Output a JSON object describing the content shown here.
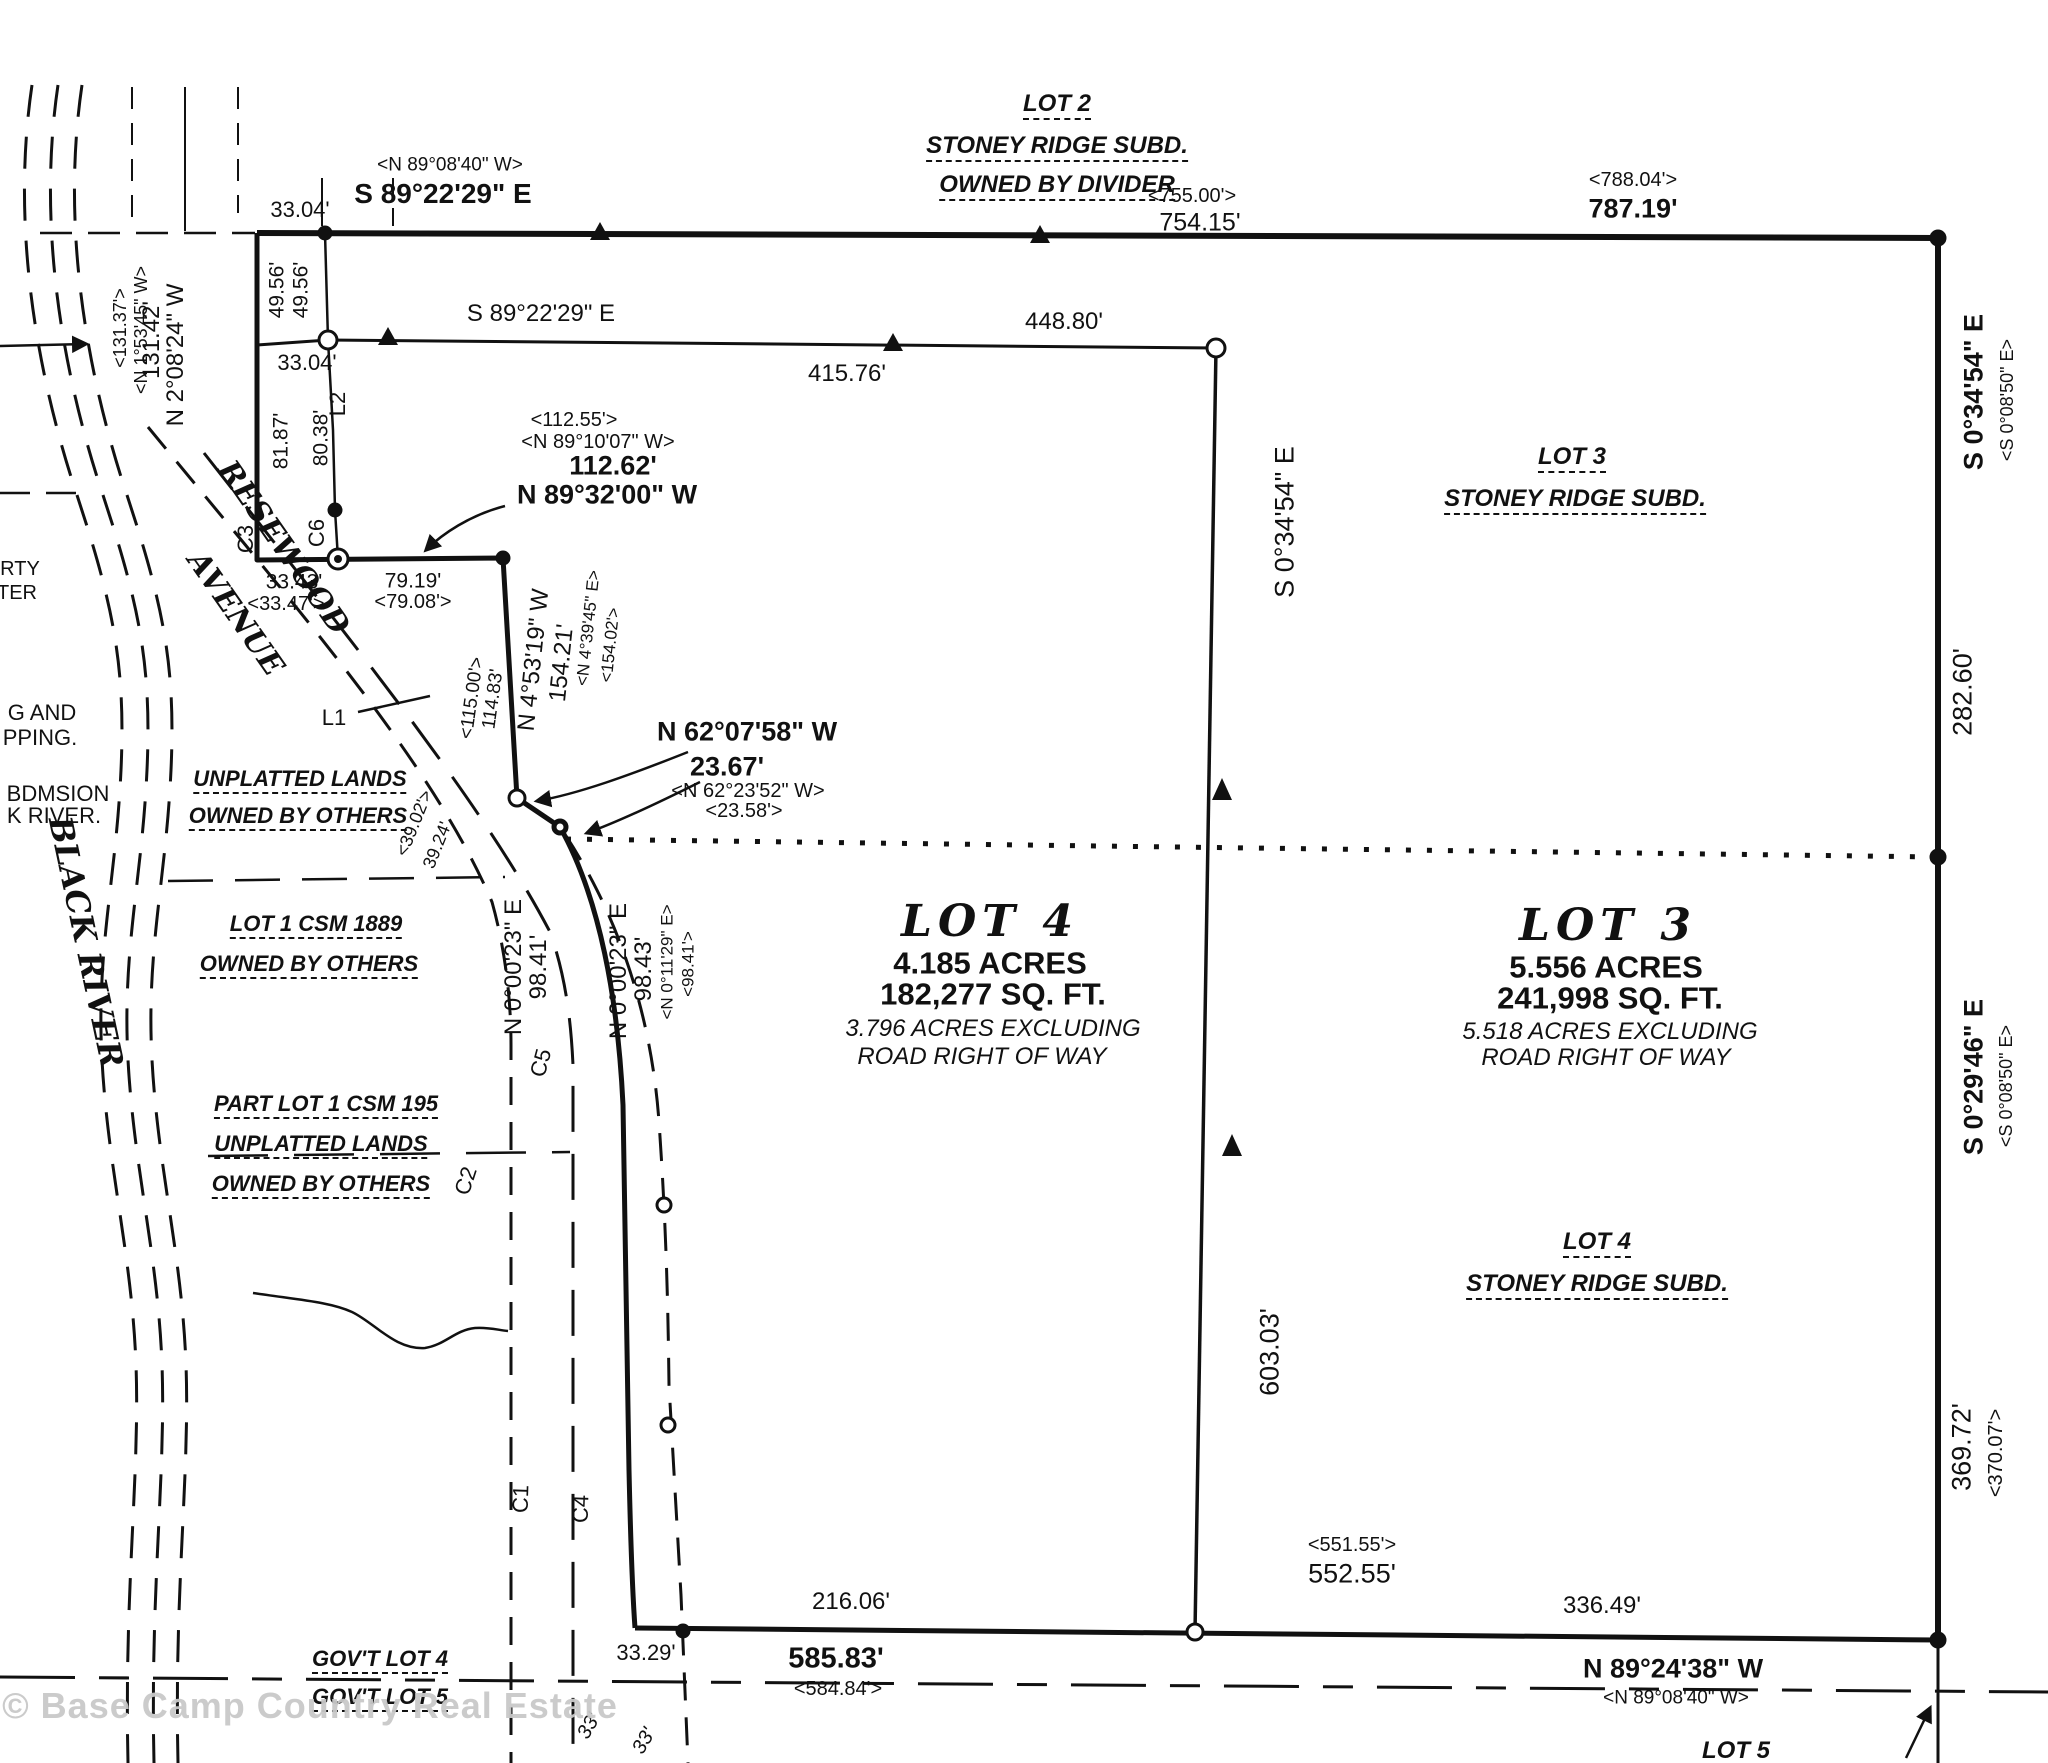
{
  "document_type": "survey-plat-drawing",
  "colors": {
    "ink": "#111111",
    "paper": "#ffffff",
    "watermark": "#c9c9c9"
  },
  "labels": [
    {
      "id": "dim-3304-top",
      "text": "33.04'",
      "x": 300,
      "y": 210,
      "size": 22
    },
    {
      "id": "brg-s892229e-top",
      "text": "S 89°22'29\" E",
      "x": 443,
      "y": 194,
      "size": 28,
      "cls": "bold"
    },
    {
      "id": "brg-n890840w-top",
      "text": "<N 89°08'40\" W>",
      "x": 450,
      "y": 165,
      "size": 19
    },
    {
      "id": "lot2-title",
      "text": "LOT 2",
      "x": 1057,
      "y": 106,
      "size": 24,
      "cls": "itu"
    },
    {
      "id": "lot2-subd",
      "text": "STONEY RIDGE SUBD.",
      "x": 1057,
      "y": 148,
      "size": 24,
      "cls": "itu"
    },
    {
      "id": "lot2-owner",
      "text": "OWNED BY DIVIDER",
      "x": 1057,
      "y": 187,
      "size": 24,
      "cls": "itu"
    },
    {
      "id": "dim-75500",
      "text": "<755.00'>",
      "x": 1192,
      "y": 196,
      "size": 20
    },
    {
      "id": "dim-75415",
      "text": "754.15'",
      "x": 1200,
      "y": 223,
      "size": 25
    },
    {
      "id": "dim-78804",
      "text": "<788.04'>",
      "x": 1633,
      "y": 180,
      "size": 20
    },
    {
      "id": "dim-78719",
      "text": "787.19'",
      "x": 1633,
      "y": 209,
      "size": 27,
      "cls": "bold"
    },
    {
      "id": "dim-4956-a",
      "text": "49.56'",
      "x": 277,
      "y": 290,
      "size": 21,
      "rot": -90
    },
    {
      "id": "dim-4956-b",
      "text": "49.56'",
      "x": 301,
      "y": 290,
      "size": 21,
      "rot": -90
    },
    {
      "id": "dim-13142",
      "text": "131.42'",
      "x": 152,
      "y": 340,
      "size": 24,
      "rot": -90
    },
    {
      "id": "brg-n20824w",
      "text": "N 2°08'24\" W",
      "x": 176,
      "y": 355,
      "size": 24,
      "rot": -90
    },
    {
      "id": "dim-13137",
      "text": "<131.37'>",
      "x": 120,
      "y": 328,
      "size": 18,
      "rot": -90
    },
    {
      "id": "brg-n15345w",
      "text": "<N 1°53'45\" W>",
      "x": 141,
      "y": 330,
      "size": 18,
      "rot": -90
    },
    {
      "id": "brg-s892229e-2",
      "text": "S 89°22'29\" E",
      "x": 541,
      "y": 314,
      "size": 24
    },
    {
      "id": "dim-44880",
      "text": "448.80'",
      "x": 1064,
      "y": 322,
      "size": 24
    },
    {
      "id": "dim-41576",
      "text": "415.76'",
      "x": 847,
      "y": 374,
      "size": 24
    },
    {
      "id": "dim-3304-2",
      "text": "33.04'",
      "x": 307,
      "y": 363,
      "size": 22
    },
    {
      "id": "lbl-l2",
      "text": "L2",
      "x": 338,
      "y": 404,
      "size": 22,
      "rot": -90
    },
    {
      "id": "dim-8187",
      "text": "81.87'",
      "x": 281,
      "y": 441,
      "size": 21,
      "rot": -90
    },
    {
      "id": "dim-8038",
      "text": "80.38'",
      "x": 321,
      "y": 438,
      "size": 21,
      "rot": -90
    },
    {
      "id": "lbl-c6",
      "text": "C6",
      "x": 317,
      "y": 533,
      "size": 22,
      "rot": -90
    },
    {
      "id": "lbl-c3",
      "text": "C3",
      "x": 246,
      "y": 539,
      "size": 22,
      "rot": -90
    },
    {
      "id": "dim-11255",
      "text": "<112.55'>",
      "x": 574,
      "y": 420,
      "size": 20
    },
    {
      "id": "brg-n891007w",
      "text": "<N 89°10'07\" W>",
      "x": 598,
      "y": 442,
      "size": 20
    },
    {
      "id": "dim-11262",
      "text": "112.62'",
      "x": 613,
      "y": 466,
      "size": 27,
      "cls": "bold"
    },
    {
      "id": "brg-n893200w",
      "text": "N 89°32'00\" W",
      "x": 607,
      "y": 495,
      "size": 27,
      "cls": "bold"
    },
    {
      "id": "dim-3343",
      "text": "33.43'",
      "x": 294,
      "y": 582,
      "size": 21
    },
    {
      "id": "dim-3347",
      "text": "<33.47'>",
      "x": 286,
      "y": 604,
      "size": 20
    },
    {
      "id": "dim-7919",
      "text": "79.19'",
      "x": 413,
      "y": 581,
      "size": 21
    },
    {
      "id": "dim-7908",
      "text": "<79.08'>",
      "x": 413,
      "y": 602,
      "size": 20
    },
    {
      "id": "road-name-resewood",
      "text": "RESEWOOD",
      "x": 283,
      "y": 548,
      "size": 30,
      "rot": 55,
      "cls": "serif"
    },
    {
      "id": "road-name-avenue",
      "text": "AVENUE",
      "x": 235,
      "y": 614,
      "size": 30,
      "rot": 55,
      "cls": "serif"
    },
    {
      "id": "dim-11500",
      "text": "<115.00'>",
      "x": 472,
      "y": 698,
      "size": 19,
      "rot": -82
    },
    {
      "id": "dim-11483",
      "text": "114.83'",
      "x": 493,
      "y": 699,
      "size": 19,
      "rot": -82
    },
    {
      "id": "brg-n45319w",
      "text": "N 4°53'19\" W",
      "x": 534,
      "y": 660,
      "size": 24,
      "rot": -84
    },
    {
      "id": "dim-15421",
      "text": "154.21'",
      "x": 562,
      "y": 663,
      "size": 24,
      "rot": -84
    },
    {
      "id": "brg-n43945e",
      "text": "<N 4°39'45\" E>",
      "x": 588,
      "y": 628,
      "size": 17,
      "rot": -84
    },
    {
      "id": "dim-15402",
      "text": "<154.02'>",
      "x": 610,
      "y": 645,
      "size": 17,
      "rot": -84
    },
    {
      "id": "brg-n620758w",
      "text": "N 62°07'58\" W",
      "x": 747,
      "y": 732,
      "size": 27,
      "cls": "bold"
    },
    {
      "id": "dim-2367",
      "text": "23.67'",
      "x": 727,
      "y": 767,
      "size": 27,
      "cls": "bold"
    },
    {
      "id": "brg-n622352w",
      "text": "<N 62°23'52\" W>",
      "x": 748,
      "y": 791,
      "size": 20
    },
    {
      "id": "dim-2358",
      "text": "<23.58'>",
      "x": 744,
      "y": 811,
      "size": 20
    },
    {
      "id": "lbl-l1",
      "text": "L1",
      "x": 334,
      "y": 718,
      "size": 22
    },
    {
      "id": "dim-3902",
      "text": "<39.02'>",
      "x": 414,
      "y": 823,
      "size": 18,
      "rot": -68
    },
    {
      "id": "dim-3924",
      "text": "39.24'",
      "x": 437,
      "y": 845,
      "size": 18,
      "rot": -68
    },
    {
      "id": "brg-n00023e-w",
      "text": "N 0°00'23\" E",
      "x": 514,
      "y": 967,
      "size": 24,
      "rot": -90
    },
    {
      "id": "dim-9841-w",
      "text": "98.41'",
      "x": 539,
      "y": 967,
      "size": 24,
      "rot": -90
    },
    {
      "id": "brg-n00023e-e",
      "text": "N 0°00'23\" E",
      "x": 619,
      "y": 971,
      "size": 24,
      "rot": -90
    },
    {
      "id": "dim-9843",
      "text": "98.43'",
      "x": 644,
      "y": 969,
      "size": 24,
      "rot": -90
    },
    {
      "id": "brg-n01129e",
      "text": "<N 0°11'29\" E>",
      "x": 667,
      "y": 962,
      "size": 17,
      "rot": -90
    },
    {
      "id": "dim-9841-e",
      "text": "<98.41'>",
      "x": 688,
      "y": 964,
      "size": 17,
      "rot": -90
    },
    {
      "id": "lbl-c2",
      "text": "C2",
      "x": 466,
      "y": 1181,
      "size": 22,
      "rot": -72
    },
    {
      "id": "lbl-c5",
      "text": "C5",
      "x": 541,
      "y": 1063,
      "size": 22,
      "rot": -75
    },
    {
      "id": "lbl-c1",
      "text": "C1",
      "x": 521,
      "y": 1499,
      "size": 22,
      "rot": -88
    },
    {
      "id": "lbl-c4",
      "text": "C4",
      "x": 581,
      "y": 1509,
      "size": 22,
      "rot": -88
    },
    {
      "id": "lot4-title",
      "text": "LOT 4",
      "x": 990,
      "y": 922,
      "size": 44,
      "cls": "serif ls"
    },
    {
      "id": "lot4-acres",
      "text": "4.185 ACRES",
      "x": 990,
      "y": 963,
      "size": 31,
      "cls": "bold"
    },
    {
      "id": "lot4-sqft",
      "text": "182,277 SQ. FT.",
      "x": 993,
      "y": 994,
      "size": 31,
      "cls": "bold"
    },
    {
      "id": "lot4-excl-1",
      "text": "3.796 ACRES EXCLUDING",
      "x": 993,
      "y": 1029,
      "size": 24,
      "cls": "it2"
    },
    {
      "id": "lot4-excl-2",
      "text": "ROAD RIGHT OF WAY",
      "x": 982,
      "y": 1057,
      "size": 24,
      "cls": "it2"
    },
    {
      "id": "lot3-title",
      "text": "LOT 3",
      "x": 1608,
      "y": 926,
      "size": 44,
      "cls": "serif ls"
    },
    {
      "id": "lot3-acres",
      "text": "5.556 ACRES",
      "x": 1606,
      "y": 967,
      "size": 31,
      "cls": "bold"
    },
    {
      "id": "lot3-sqft",
      "text": "241,998 SQ. FT.",
      "x": 1610,
      "y": 998,
      "size": 31,
      "cls": "bold"
    },
    {
      "id": "lot3-excl-1",
      "text": "5.518 ACRES EXCLUDING",
      "x": 1610,
      "y": 1032,
      "size": 24,
      "cls": "it2"
    },
    {
      "id": "lot3-excl-2",
      "text": "ROAD RIGHT OF WAY",
      "x": 1606,
      "y": 1058,
      "size": 24,
      "cls": "it2"
    },
    {
      "id": "lot3-ne-title",
      "text": "LOT 3",
      "x": 1572,
      "y": 459,
      "size": 24,
      "cls": "itu"
    },
    {
      "id": "lot3-ne-subd",
      "text": "STONEY RIDGE SUBD.",
      "x": 1575,
      "y": 501,
      "size": 24,
      "cls": "itu"
    },
    {
      "id": "lot4-se-title",
      "text": "LOT 4",
      "x": 1597,
      "y": 1244,
      "size": 24,
      "cls": "itu"
    },
    {
      "id": "lot4-se-subd",
      "text": "STONEY RIDGE SUBD.",
      "x": 1597,
      "y": 1286,
      "size": 24,
      "cls": "itu"
    },
    {
      "id": "brg-s03454e-right",
      "text": "S 0°34'54\" E",
      "x": 1974,
      "y": 392,
      "size": 27,
      "rot": -90,
      "cls": "bold"
    },
    {
      "id": "brg-s00850e-r1",
      "text": "<S 0°08'50\" E>",
      "x": 2007,
      "y": 400,
      "size": 18,
      "rot": -90
    },
    {
      "id": "dim-28260",
      "text": "282.60'",
      "x": 1963,
      "y": 692,
      "size": 27,
      "rot": -90
    },
    {
      "id": "brg-s02946e",
      "text": "S 0°29'46\" E",
      "x": 1974,
      "y": 1077,
      "size": 27,
      "rot": -90,
      "cls": "bold"
    },
    {
      "id": "brg-s00850e-r2",
      "text": "<S 0°08'50\" E>",
      "x": 2006,
      "y": 1086,
      "size": 18,
      "rot": -90
    },
    {
      "id": "dim-36972",
      "text": "369.72'",
      "x": 1962,
      "y": 1447,
      "size": 27,
      "rot": -90
    },
    {
      "id": "dim-37007",
      "text": "<370.07'>",
      "x": 1996,
      "y": 1453,
      "size": 20,
      "rot": -90
    },
    {
      "id": "brg-s03454e-int",
      "text": "S 0°34'54\" E",
      "x": 1285,
      "y": 522,
      "size": 27,
      "rot": -90
    },
    {
      "id": "dim-60303",
      "text": "603.03'",
      "x": 1270,
      "y": 1352,
      "size": 27,
      "rot": -90
    },
    {
      "id": "dim-55155",
      "text": "<551.55'>",
      "x": 1352,
      "y": 1545,
      "size": 20
    },
    {
      "id": "dim-55255",
      "text": "552.55'",
      "x": 1352,
      "y": 1574,
      "size": 27
    },
    {
      "id": "dim-21606",
      "text": "216.06'",
      "x": 851,
      "y": 1602,
      "size": 24
    },
    {
      "id": "dim-3329",
      "text": "33.29'",
      "x": 646,
      "y": 1653,
      "size": 22
    },
    {
      "id": "dim-58583",
      "text": "585.83'",
      "x": 836,
      "y": 1659,
      "size": 29,
      "cls": "bold"
    },
    {
      "id": "dim-58484",
      "text": "<584.84'>",
      "x": 838,
      "y": 1689,
      "size": 20
    },
    {
      "id": "dim-33649",
      "text": "336.49'",
      "x": 1602,
      "y": 1606,
      "size": 24
    },
    {
      "id": "brg-n892438w",
      "text": "N 89°24'38\" W",
      "x": 1673,
      "y": 1669,
      "size": 27,
      "cls": "bold"
    },
    {
      "id": "brg-n890840w-bot",
      "text": "<N 89°08'40\" W>",
      "x": 1676,
      "y": 1698,
      "size": 19
    },
    {
      "id": "govt-lot4",
      "text": "GOV'T LOT 4",
      "x": 380,
      "y": 1661,
      "size": 22,
      "cls": "itu"
    },
    {
      "id": "govt-lot5",
      "text": "GOV'T LOT 5",
      "x": 380,
      "y": 1699,
      "size": 22,
      "cls": "itu"
    },
    {
      "id": "dim-33-a",
      "text": "33'",
      "x": 589,
      "y": 1726,
      "size": 20,
      "rot": -60,
      "cls": "it2"
    },
    {
      "id": "dim-33-b",
      "text": "33'",
      "x": 644,
      "y": 1741,
      "size": 20,
      "rot": -60,
      "cls": "it2"
    },
    {
      "id": "lot5-se",
      "text": "LOT 5",
      "x": 1736,
      "y": 1753,
      "size": 24,
      "cls": "itu"
    },
    {
      "id": "cut-rty",
      "text": "RTY",
      "x": 20,
      "y": 569,
      "size": 20
    },
    {
      "id": "cut-ter",
      "text": "TER",
      "x": 17,
      "y": 593,
      "size": 20
    },
    {
      "id": "cut-g-and",
      "text": "G AND",
      "x": 42,
      "y": 713,
      "size": 22
    },
    {
      "id": "cut-pping",
      "text": "PPING.",
      "x": 40,
      "y": 738,
      "size": 22
    },
    {
      "id": "cut-bdmsion",
      "text": "BDMSION",
      "x": 58,
      "y": 794,
      "size": 22
    },
    {
      "id": "cut-k-river",
      "text": "K RIVER.",
      "x": 54,
      "y": 816,
      "size": 22
    },
    {
      "id": "unplatted-1a",
      "text": "UNPLATTED LANDS",
      "x": 300,
      "y": 781,
      "size": 22,
      "cls": "itu"
    },
    {
      "id": "unplatted-1b",
      "text": "OWNED BY OTHERS",
      "x": 298,
      "y": 818,
      "size": 22,
      "cls": "itu"
    },
    {
      "id": "csm1889-a",
      "text": "LOT 1 CSM 1889",
      "x": 316,
      "y": 926,
      "size": 22,
      "cls": "itu"
    },
    {
      "id": "csm1889-b",
      "text": "OWNED BY OTHERS",
      "x": 309,
      "y": 966,
      "size": 22,
      "cls": "itu"
    },
    {
      "id": "csm195-a",
      "text": "PART LOT 1 CSM 195",
      "x": 326,
      "y": 1106,
      "size": 22,
      "cls": "itu"
    },
    {
      "id": "csm195-b",
      "text": "UNPLATTED LANDS",
      "x": 321,
      "y": 1146,
      "size": 22,
      "cls": "itu"
    },
    {
      "id": "csm195-c",
      "text": "OWNED BY OTHERS",
      "x": 321,
      "y": 1186,
      "size": 22,
      "cls": "itu"
    },
    {
      "id": "river-name",
      "text": "BLACK RIVER",
      "x": 86,
      "y": 942,
      "size": 32,
      "rot": 78,
      "cls": "serif"
    },
    {
      "id": "watermark",
      "text": "© Base Camp Country Real Estate",
      "x": 310,
      "y": 1706,
      "size": 36,
      "cls": "wm"
    }
  ]
}
